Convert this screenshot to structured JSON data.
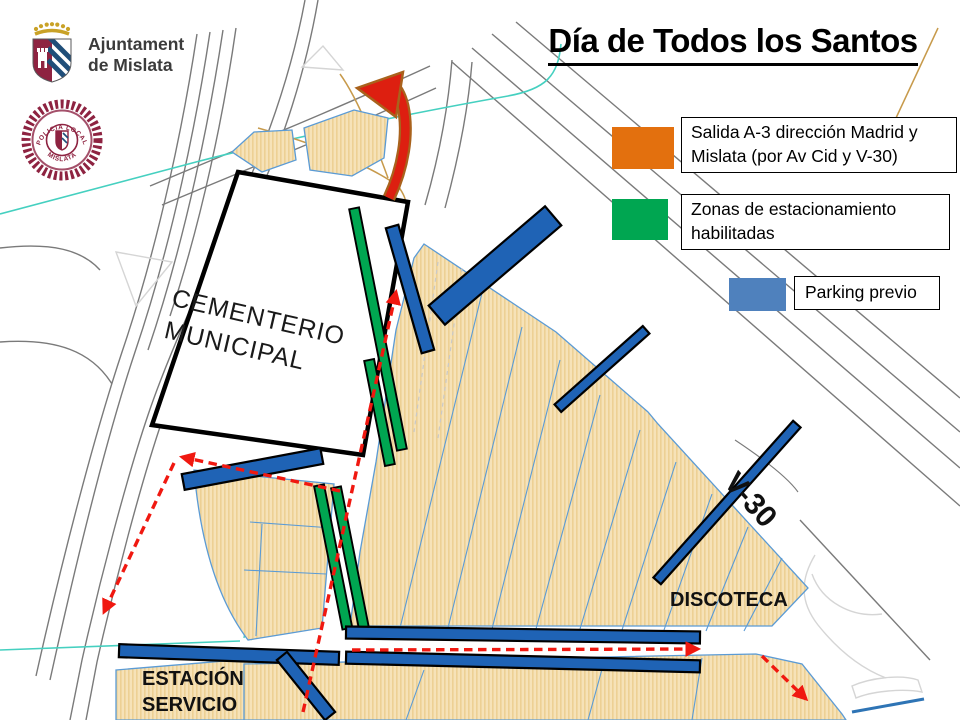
{
  "slide": {
    "title": "Día de Todos los Santos"
  },
  "branding": {
    "council_name_line1": "Ajuntament",
    "council_name_line2": "de Mislata",
    "police_badge_text_top": "POLICIA LOCAL",
    "police_badge_text_bottom": "MISLATA"
  },
  "legend": {
    "exit_route": {
      "label": "Salida A-3 dirección Madrid y Mislata (por Av Cid y V-30)",
      "color": "#E3700E"
    },
    "parking_zones": {
      "label": "Zonas de estacionamiento habilitadas",
      "color": "#00A651"
    },
    "pre_parking": {
      "label": "Parking previo",
      "color": "#4F81BD"
    }
  },
  "map_labels": {
    "cemetery_line1": "CEMENTERIO",
    "cemetery_line2": "MUNICIPAL",
    "highway": "V-30",
    "disco": "DISCOTECA",
    "gas_station_line1": "ESTACIÓN",
    "gas_station_line2": "SERVICIO"
  },
  "map_colors": {
    "parking_strip_blue": "#1F63B5",
    "zone_green": "#00A651",
    "route_red": "#F01810",
    "zone_tan": "#F6E2B8",
    "teal_line": "#45D0C0",
    "brand_maroon": "#8E2341"
  }
}
